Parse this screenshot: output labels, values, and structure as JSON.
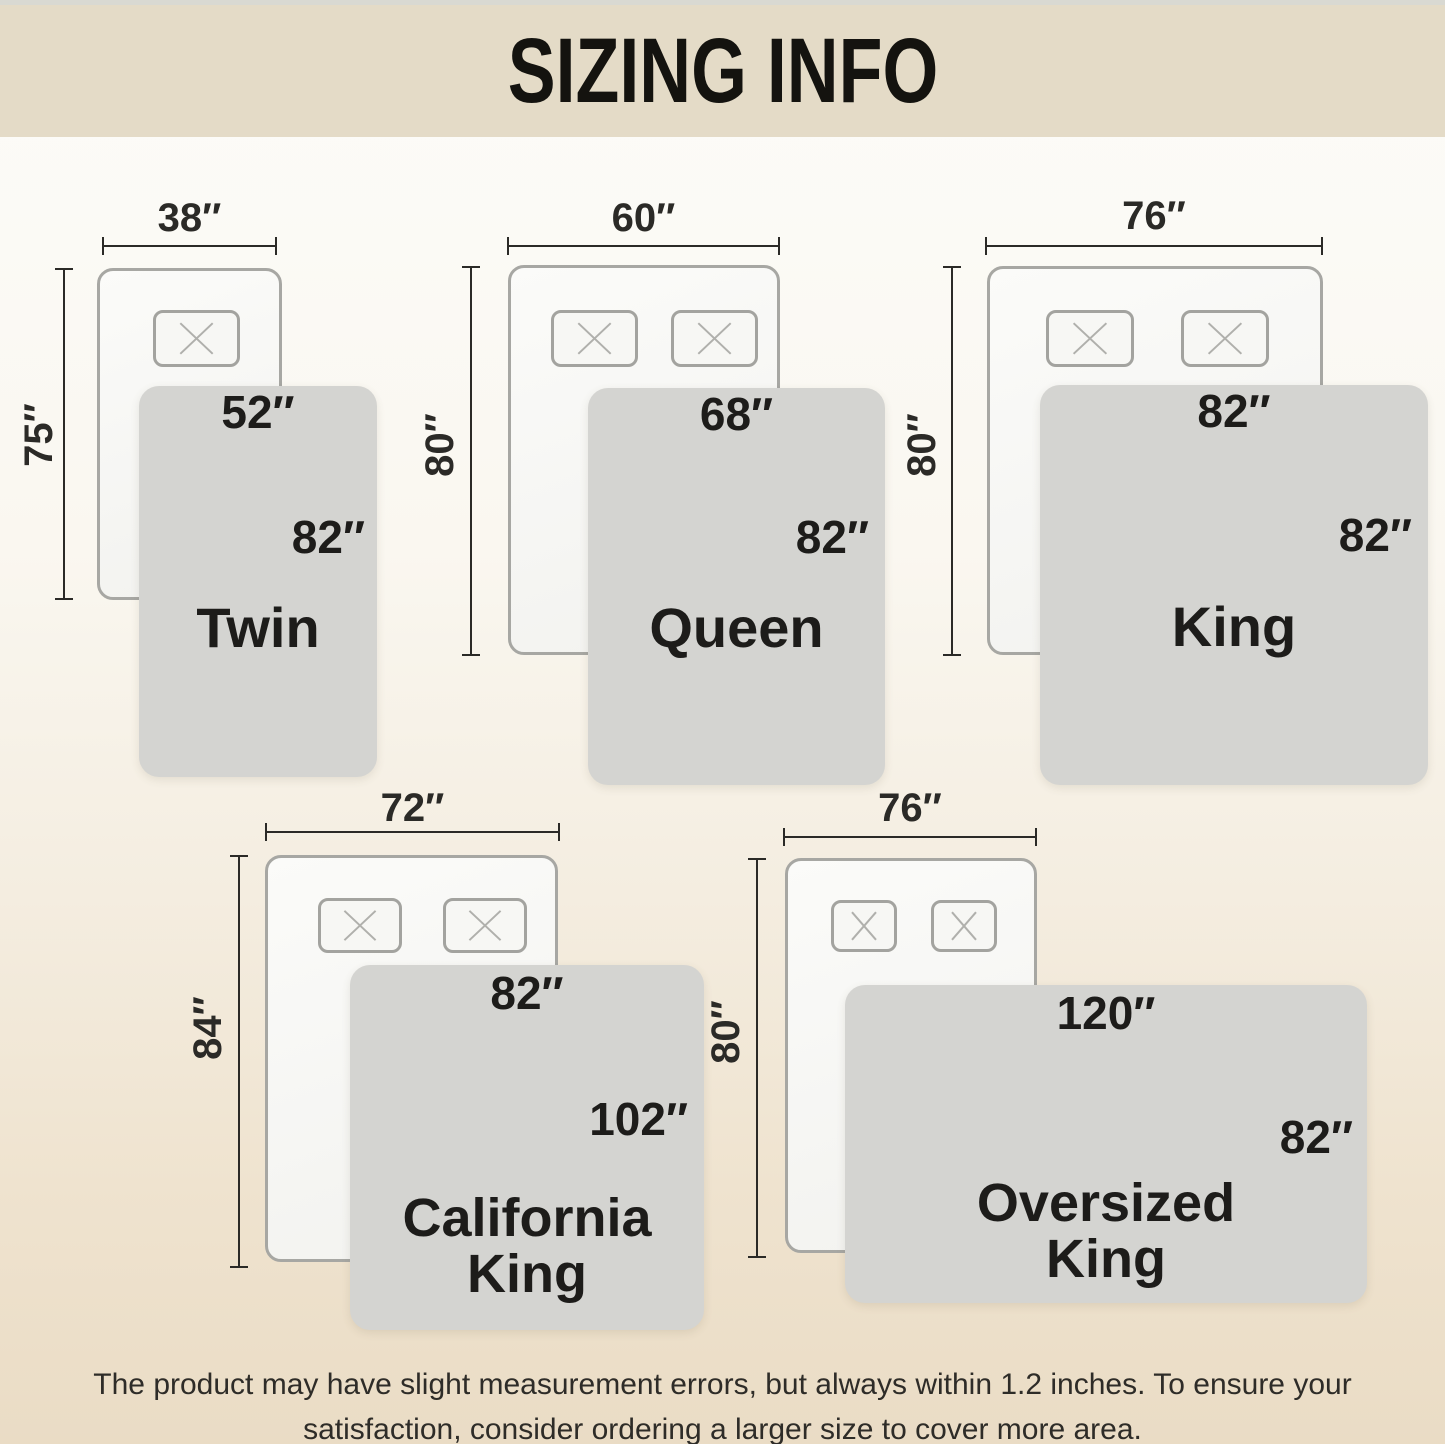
{
  "title": "SIZING INFO",
  "sizes": {
    "twin": {
      "name": "Twin",
      "bed_width": "38″",
      "bed_length": "75″",
      "blanket_width": "52″",
      "blanket_length": "82″",
      "pillow_count": 1
    },
    "queen": {
      "name": "Queen",
      "bed_width": "60″",
      "bed_length": "80″",
      "blanket_width": "68″",
      "blanket_length": "82″",
      "pillow_count": 2
    },
    "king": {
      "name": "King",
      "bed_width": "76″",
      "bed_length": "80″",
      "blanket_width": "82″",
      "blanket_length": "82″",
      "pillow_count": 2
    },
    "cal_king": {
      "name_line1": "California",
      "name_line2": "King",
      "bed_width": "72″",
      "bed_length": "84″",
      "blanket_width": "82″",
      "blanket_length": "102″",
      "pillow_count": 2
    },
    "oversized_king": {
      "name_line1": "Oversized",
      "name_line2": "King",
      "bed_width": "76″",
      "bed_length": "80″",
      "blanket_width": "120″",
      "blanket_length": "82″",
      "pillow_count": 2
    }
  },
  "footer": {
    "line1": "The product may have slight measurement errors, but always within 1.2 inches. To ensure your",
    "line2": "satisfaction, consider ordering a larger size to cover more area."
  },
  "colors": {
    "banner_bg": "#e4dbc7",
    "bg_top": "#fcfcf9",
    "bg_bottom": "#eadcc5",
    "blanket": "#d4d4d1",
    "bed_fill": "#f2f2ef",
    "bed_border": "#a7a7a3",
    "ink": "#2b2a27"
  }
}
